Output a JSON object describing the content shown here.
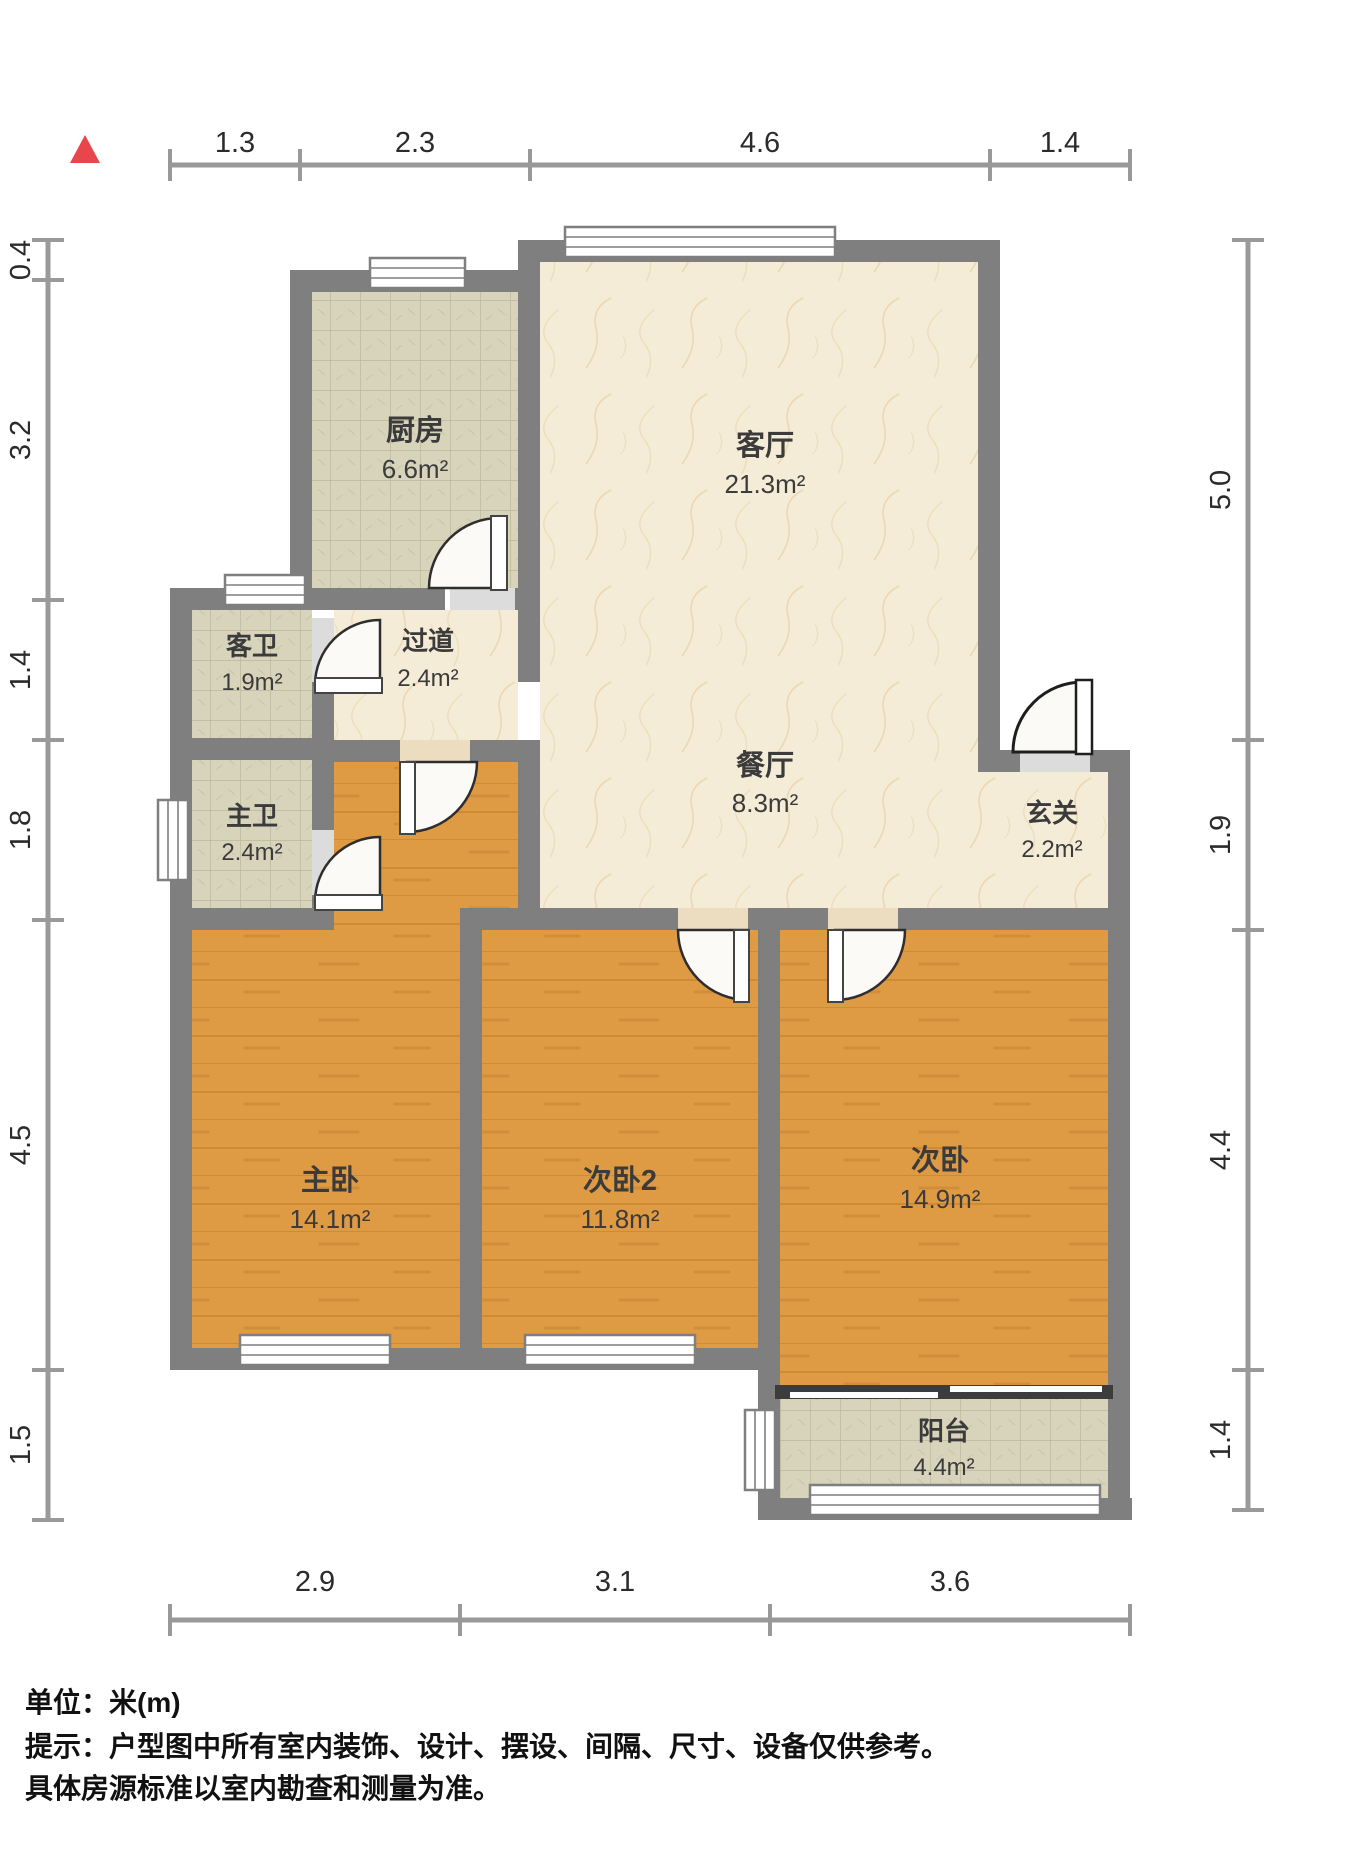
{
  "rooms": [
    {
      "name": "厨房",
      "area": "6.6m²"
    },
    {
      "name": "客厅",
      "area": "21.3m²"
    },
    {
      "name": "客卫",
      "area": "1.9m²"
    },
    {
      "name": "过道",
      "area": "2.4m²"
    },
    {
      "name": "主卫",
      "area": "2.4m²"
    },
    {
      "name": "餐厅",
      "area": "8.3m²"
    },
    {
      "name": "玄关",
      "area": "2.2m²"
    },
    {
      "name": "主卧",
      "area": "14.1m²"
    },
    {
      "name": "次卧2",
      "area": "11.8m²"
    },
    {
      "name": "次卧",
      "area": "14.9m²"
    },
    {
      "name": "阳台",
      "area": "4.4m²"
    }
  ],
  "dimensions": {
    "top": [
      "1.3",
      "2.3",
      "4.6",
      "1.4"
    ],
    "left": [
      "0.4",
      "3.2",
      "1.4",
      "1.8",
      "4.5",
      "1.5"
    ],
    "right": [
      "5.0",
      "1.9",
      "4.4",
      "1.4"
    ],
    "bottom": [
      "2.9",
      "3.1",
      "3.6"
    ]
  },
  "footer": {
    "unit": "单位：米(m)",
    "line1": "提示：户型图中所有室内装饰、设计、摆设、间隔、尺寸、设备仅供参考。",
    "line2": "具体房源标准以室内勘查和测量为准。"
  },
  "colors": {
    "wall": "#7f7f7f",
    "wood_floor": "#df9a44",
    "tile_floor": "#d8d4bb",
    "marble_floor": "#f5ecd7",
    "compass_red": "#e8464a",
    "dimension_line": "#999999"
  }
}
